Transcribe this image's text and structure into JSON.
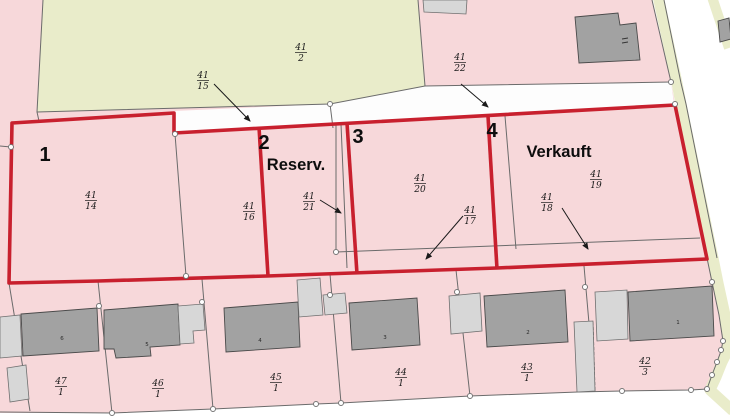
{
  "map_title": "Baugrundstuecke Lageplan",
  "plots": [
    {
      "label": "1",
      "status": ""
    },
    {
      "label": "2",
      "status": "Reserv."
    },
    {
      "label": "3",
      "status": ""
    },
    {
      "label": "4",
      "status": "Verkauft"
    }
  ],
  "parcels": {
    "f41_2": {
      "num": "41",
      "den": "2"
    },
    "f41_15": {
      "num": "41",
      "den": "15"
    },
    "f41_22": {
      "num": "41",
      "den": "22"
    },
    "f41_14": {
      "num": "41",
      "den": "14"
    },
    "f41_16": {
      "num": "41",
      "den": "16"
    },
    "f41_21": {
      "num": "41",
      "den": "21"
    },
    "f41_20": {
      "num": "41",
      "den": "20"
    },
    "f41_17": {
      "num": "41",
      "den": "17"
    },
    "f41_18": {
      "num": "41",
      "den": "18"
    },
    "f41_19": {
      "num": "41",
      "den": "19"
    },
    "f47_1": {
      "num": "47",
      "den": "1"
    },
    "f46_1": {
      "num": "46",
      "den": "1"
    },
    "f45_1": {
      "num": "45",
      "den": "1"
    },
    "f44_1": {
      "num": "44",
      "den": "1"
    },
    "f43_1": {
      "num": "43",
      "den": "1"
    },
    "f42_3": {
      "num": "42",
      "den": "3"
    }
  },
  "buildings": {
    "h6": "6",
    "h5": "5",
    "h4": "4",
    "h3": "3",
    "h2": "2",
    "h1": "1"
  },
  "colors": {
    "parcel_pink": "#f7d8da",
    "field_green": "#e9ecca",
    "highlight_red": "#c8202e",
    "road_white": "#ffffff",
    "building_dark": "#a2a2a2",
    "building_light": "#d7d7d7",
    "boundary_gray": "#6b6b6b"
  }
}
